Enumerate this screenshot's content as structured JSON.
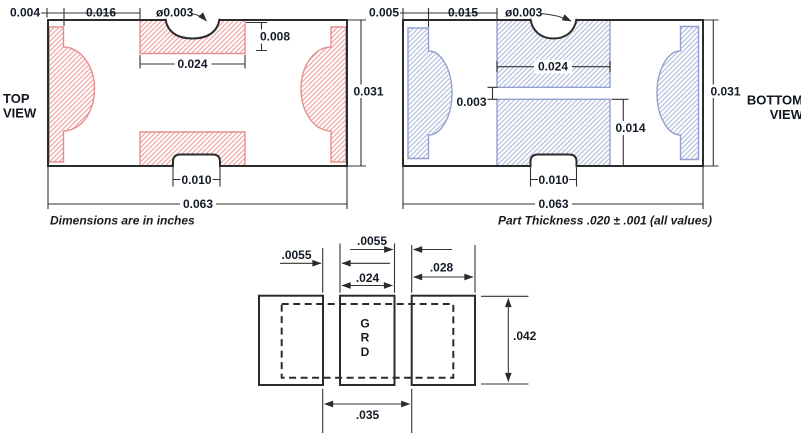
{
  "top_view": {
    "label_line1": "TOP",
    "label_line2": "VIEW",
    "note": "Dimensions are in inches",
    "dims": {
      "band_width": "0.004",
      "band_to_pad": "0.016",
      "hole_dia": "ø0.003",
      "pad_height": "0.008",
      "pad_width": "0.024",
      "body_height": "0.031",
      "notch_width": "0.010",
      "body_width": "0.063"
    }
  },
  "bottom_view": {
    "label_line1": "BOTTOM",
    "label_line2": "VIEW",
    "note": "Part Thickness .020 ± .001 (all values)",
    "dims": {
      "band_width": "0.005",
      "band_to_pad": "0.015",
      "hole_dia": "ø0.003",
      "pad_width": "0.024",
      "gap": "0.003",
      "lower_pad_height": "0.014",
      "body_height": "0.031",
      "notch_width": "0.010",
      "body_width": "0.063"
    }
  },
  "land_pattern": {
    "dims": {
      "gap_left": ".0055",
      "gap_right": ".0055",
      "center_pad_width": ".024",
      "outer_pad_width": ".028",
      "pad_height": ".042",
      "inner_span": ".035"
    },
    "marking": [
      "G",
      "R",
      "D"
    ]
  },
  "colors": {
    "red_hatch": "#f0a3a3",
    "red_edge": "#e5908f",
    "blue_hatch": "#b5bfde",
    "blue_edge": "#93a0cf",
    "line": "#2b2b2b",
    "text": "#131a26"
  }
}
